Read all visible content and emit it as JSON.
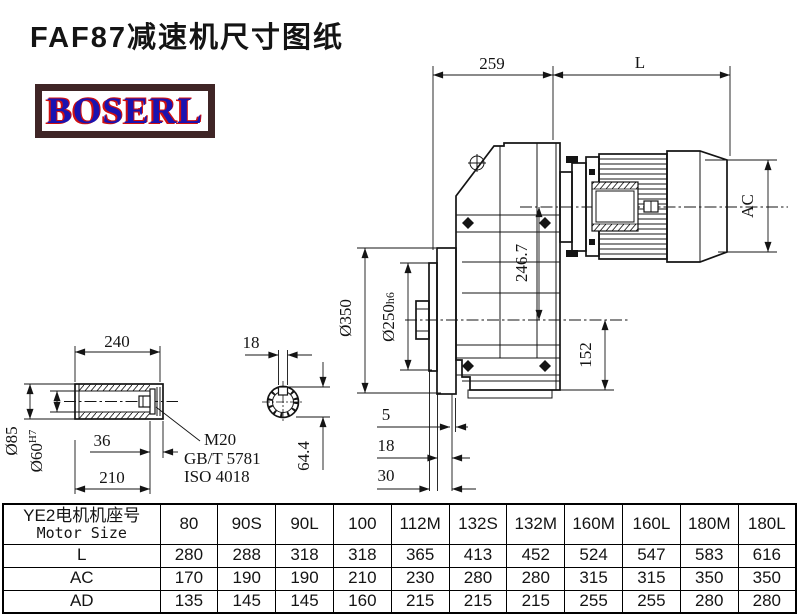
{
  "title": "FAF87减速机尺寸图纸",
  "logo": {
    "text": "BOSERL",
    "text_color": "#1a12b0",
    "fringe_color": "#d01010",
    "border_color": "#3f2526"
  },
  "drawing": {
    "line_color": "#141414",
    "dims": {
      "top_width": "259",
      "motor_length": "L",
      "motor_diameter": "AC",
      "axis_height": "246.7",
      "foot_to_axis": "152",
      "flange_od": "Ø350",
      "spigot_od": "Ø250",
      "spigot_tol": "h6",
      "face_offset_1": "5",
      "face_offset_2": "18",
      "face_offset_3": "30",
      "shaft_length": "240",
      "shaft_od": "Ø85",
      "bore_dia": "Ø60",
      "bore_tol": "H7",
      "retainer_depth": "36",
      "bore_depth": "210",
      "keyway_width": "18",
      "keyway_height": "64.4",
      "bolt_thread": "M20",
      "bolt_std_gb": "GB/T 5781",
      "bolt_std_iso": "ISO 4018"
    }
  },
  "table": {
    "header_cn": "YE2电机机座号",
    "header_en": "Motor Size",
    "columns": [
      "80",
      "90S",
      "90L",
      "100",
      "112M",
      "132S",
      "132M",
      "160M",
      "160L",
      "180M",
      "180L"
    ],
    "rows": [
      {
        "label": "L",
        "values": [
          "280",
          "288",
          "318",
          "318",
          "365",
          "413",
          "452",
          "524",
          "547",
          "583",
          "616"
        ]
      },
      {
        "label": "AC",
        "values": [
          "170",
          "190",
          "190",
          "210",
          "230",
          "280",
          "280",
          "315",
          "315",
          "350",
          "350"
        ]
      },
      {
        "label": "AD",
        "values": [
          "135",
          "145",
          "145",
          "160",
          "215",
          "215",
          "215",
          "255",
          "255",
          "280",
          "280"
        ]
      }
    ]
  }
}
